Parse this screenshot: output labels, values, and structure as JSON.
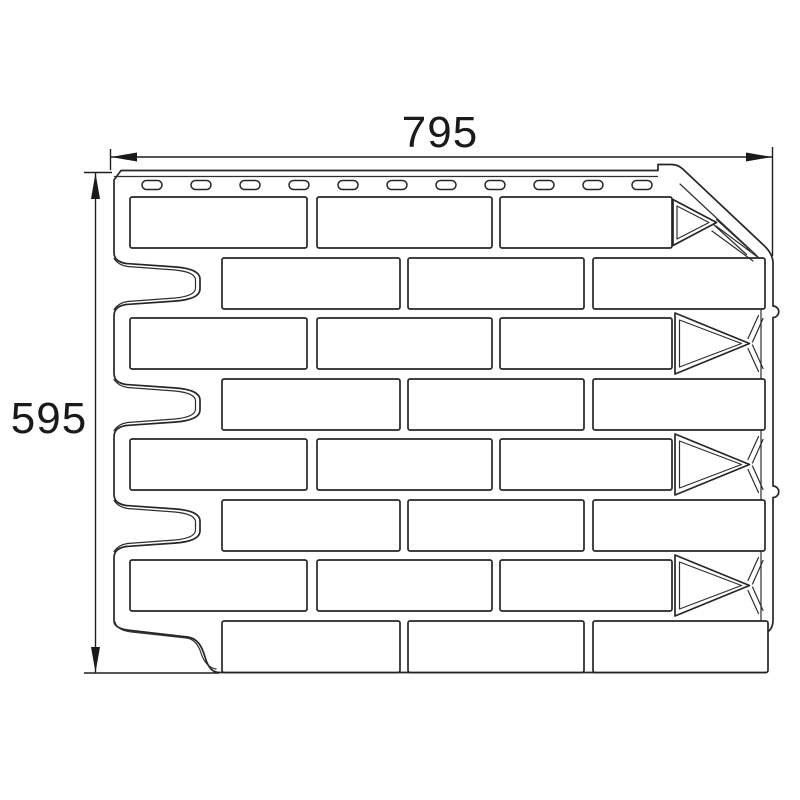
{
  "drawing": {
    "description": "Technical dimension drawing of a brick-pattern facade panel",
    "width_label": "795",
    "height_label": "595",
    "nail_slot_count": 11,
    "brick_row_count": 8,
    "left_notch_count": 3,
    "line_color": "#262626",
    "background_color": "#ffffff"
  }
}
